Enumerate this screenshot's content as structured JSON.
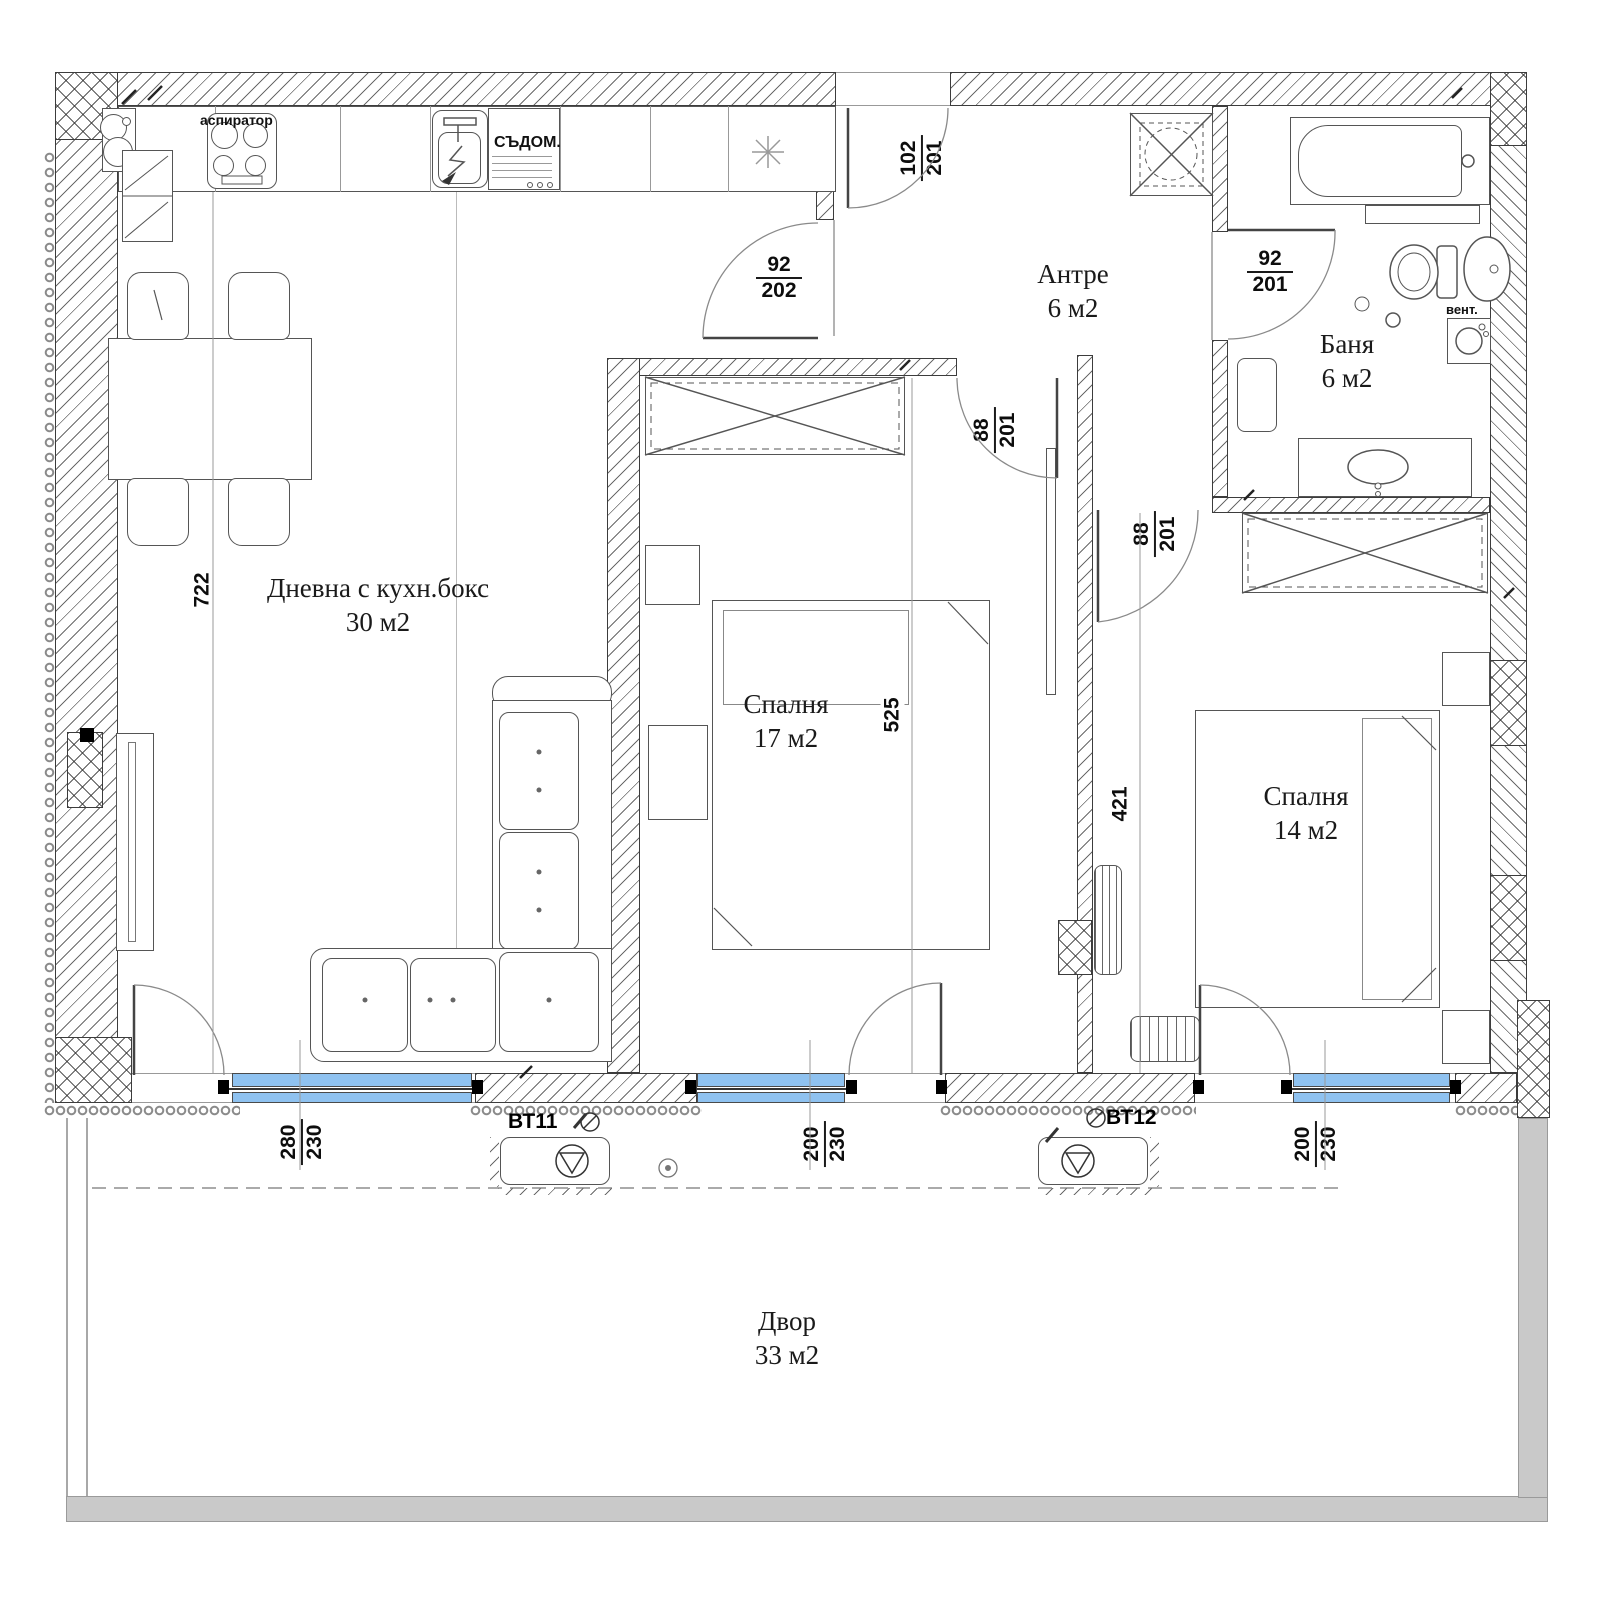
{
  "rooms": {
    "living": {
      "name": "Дневна с кухн.бокс",
      "area": "30 м2"
    },
    "bedroom1": {
      "name": "Спалня",
      "area": "17 м2"
    },
    "bedroom2": {
      "name": "Спалня",
      "area": "14 м2"
    },
    "hall": {
      "name": "Антре",
      "area": "6 м2"
    },
    "bath": {
      "name": "Баня",
      "area": "6 м2"
    },
    "yard": {
      "name": "Двор",
      "area": "33 м2"
    }
  },
  "doors": {
    "entry": {
      "width": "102",
      "height": "201"
    },
    "living_hall": {
      "width": "92",
      "height": "202"
    },
    "bath": {
      "width": "92",
      "height": "201"
    },
    "bedroom1": {
      "width": "88",
      "height": "201"
    },
    "bedroom2": {
      "width": "88",
      "height": "201"
    }
  },
  "windows": {
    "living": {
      "width": "280",
      "height": "230"
    },
    "bedroom1": {
      "width": "200",
      "height": "230"
    },
    "bedroom2": {
      "width": "200",
      "height": "230"
    }
  },
  "dims": {
    "living": "722",
    "bedroom1": "525",
    "bedroom2": "421"
  },
  "labels": {
    "hood": "аспиратор",
    "dishwasher": "СЪДОМ.",
    "vent": "вент.",
    "vt11": "ВТ11",
    "vt12": "ВТ12"
  },
  "colors": {
    "window_glass": "#8FC2F0",
    "terrace_wall": "#c9c9c9",
    "wall_line": "#3c3c3c"
  }
}
